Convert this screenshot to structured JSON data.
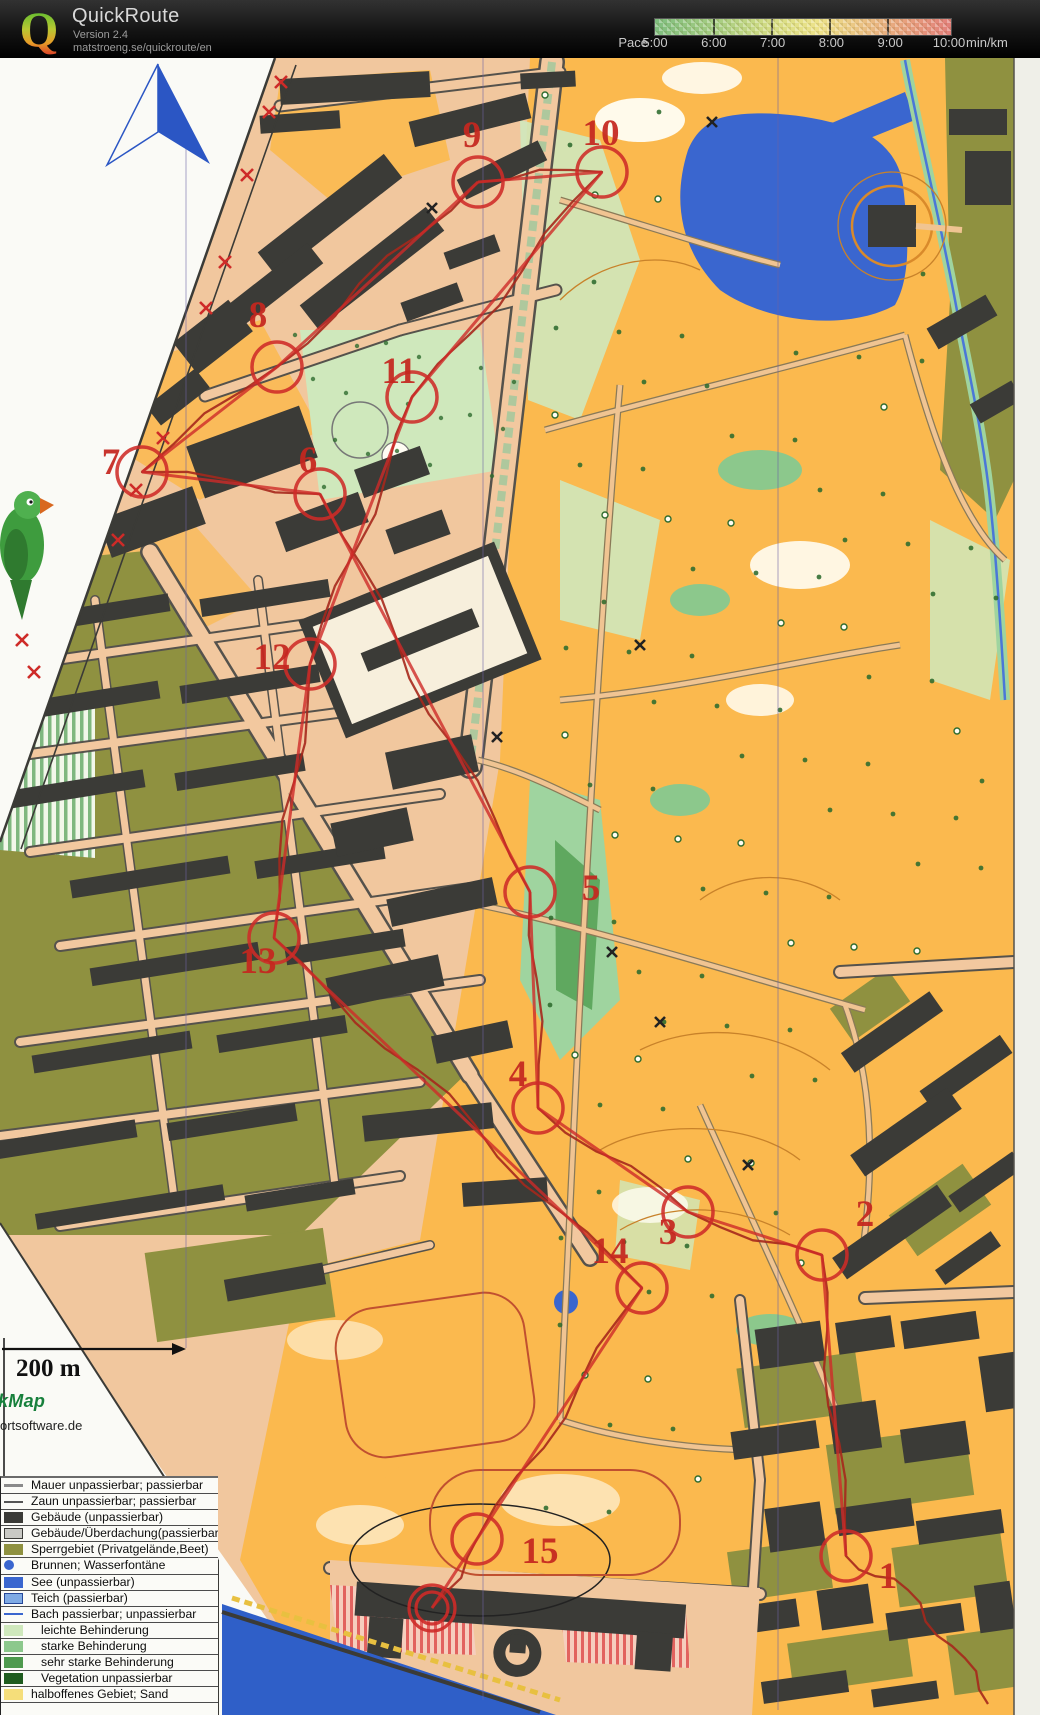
{
  "header": {
    "logo_letter": "Q",
    "app_title": "QuickRoute",
    "version": "Version 2.4",
    "url": "matstroeng.se/quickroute/en",
    "pace": {
      "label": "Pace",
      "unit": "min/km",
      "ticks": [
        "5:00",
        "6:00",
        "7:00",
        "8:00",
        "9:00",
        "10:00"
      ]
    }
  },
  "map": {
    "scale_label": "200 m",
    "credit_line1": "kMap",
    "credit_line2": "ortsoftware.de",
    "controls": [
      {
        "number": "1",
        "label_x": 888,
        "label_y": 1588,
        "cx": 846,
        "cy": 1556
      },
      {
        "number": "2",
        "label_x": 865,
        "label_y": 1226,
        "cx": 822,
        "cy": 1255
      },
      {
        "number": "3",
        "label_x": 668,
        "label_y": 1244,
        "cx": 688,
        "cy": 1212
      },
      {
        "number": "4",
        "label_x": 518,
        "label_y": 1086,
        "cx": 538,
        "cy": 1108
      },
      {
        "number": "5",
        "label_x": 591,
        "label_y": 900,
        "cx": 530,
        "cy": 892
      },
      {
        "number": "6",
        "label_x": 308,
        "label_y": 472,
        "cx": 320,
        "cy": 494
      },
      {
        "number": "7",
        "label_x": 111,
        "label_y": 474,
        "cx": 142,
        "cy": 472
      },
      {
        "number": "8",
        "label_x": 258,
        "label_y": 327,
        "cx": 277,
        "cy": 367
      },
      {
        "number": "9",
        "label_x": 472,
        "label_y": 147,
        "cx": 478,
        "cy": 182
      },
      {
        "number": "10",
        "label_x": 601,
        "label_y": 145,
        "cx": 602,
        "cy": 172
      },
      {
        "number": "11",
        "label_x": 399,
        "label_y": 383,
        "cx": 412,
        "cy": 397
      },
      {
        "number": "12",
        "label_x": 272,
        "label_y": 669,
        "cx": 310,
        "cy": 664
      },
      {
        "number": "13",
        "label_x": 258,
        "label_y": 973,
        "cx": 274,
        "cy": 938
      },
      {
        "number": "14",
        "label_x": 610,
        "label_y": 1263,
        "cx": 642,
        "cy": 1288
      },
      {
        "number": "15",
        "label_x": 540,
        "label_y": 1563,
        "cx": 477,
        "cy": 1539
      }
    ],
    "finish": {
      "cx": 432,
      "cy": 1608
    },
    "legend_items": [
      {
        "label": "Mauer unpassierbar; passierbar",
        "symbol": "wall",
        "indent": false
      },
      {
        "label": "Zaun unpassierbar; passierbar",
        "symbol": "fence",
        "indent": false
      },
      {
        "label": "Gebäude (unpassierbar)",
        "symbol": "building",
        "indent": false
      },
      {
        "label": "Gebäude/Überdachung(passierbar)",
        "symbol": "canopy",
        "indent": false
      },
      {
        "label": "Sperrgebiet (Privatgelände,Beet)",
        "symbol": "restricted",
        "indent": false
      },
      {
        "label": "Brunnen; Wasserfontäne",
        "symbol": "fountain",
        "indent": false
      },
      {
        "label": "See (unpassierbar)",
        "symbol": "lake",
        "indent": false
      },
      {
        "label": "Teich (passierbar)",
        "symbol": "pond",
        "indent": false
      },
      {
        "label": "Bach passierbar; unpassierbar",
        "symbol": "stream",
        "indent": false
      },
      {
        "label": "leichte Behinderung",
        "symbol": "green1",
        "indent": true
      },
      {
        "label": "starke Behinderung",
        "symbol": "green2",
        "indent": true
      },
      {
        "label": "sehr starke Behinderung",
        "symbol": "green3",
        "indent": true
      },
      {
        "label": "Vegetation unpassierbar",
        "symbol": "green4",
        "indent": true
      },
      {
        "label": "halboffenes Gebiet; Sand",
        "symbol": "sand",
        "indent": false
      }
    ]
  },
  "colors": {
    "overprint_red": "#CE2B28",
    "gps_track": "#A6281C",
    "park_yellow": "#FBB94E",
    "paper_salmon": "#F1C79E",
    "olive": "#8F9140",
    "building_gray": "#3B3B37",
    "lake_blue": "#3A66CF",
    "light_green": "#CFE8BC",
    "pace_green": "#7FBE7F",
    "pace_red": "#E3807B"
  }
}
